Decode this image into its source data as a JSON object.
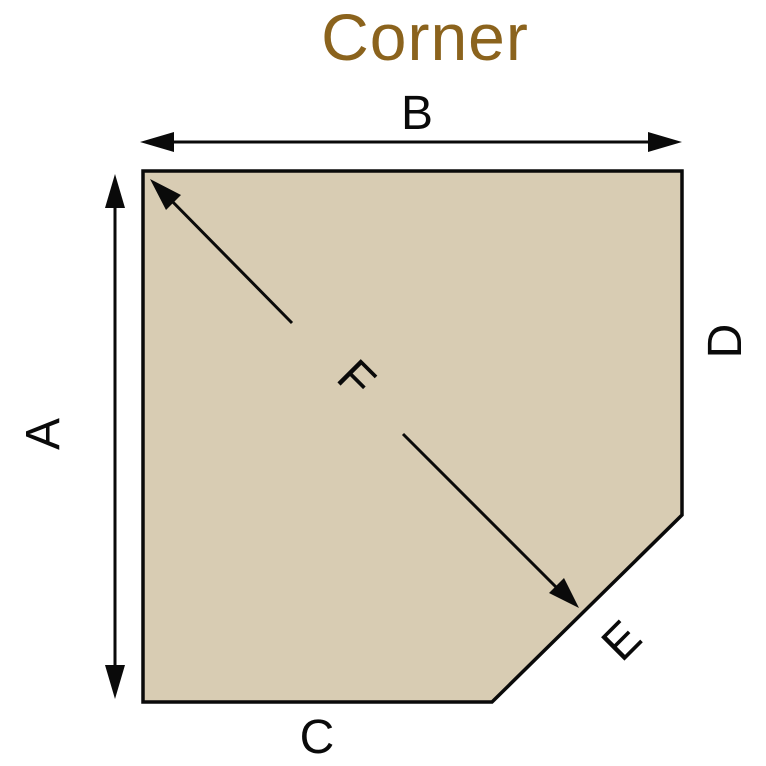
{
  "title": {
    "text": "Corner",
    "color": "#8B631D"
  },
  "canvas": {
    "background": "#FFFFFF",
    "ink": "#0A0A0A"
  },
  "shape": {
    "description": "square pad with clipped bottom-right corner (pentagon)",
    "fill": "#D8CCB3",
    "stroke": "#0A0A0A",
    "points": "143,171 682,171 682,515 492,702 143,702"
  },
  "dimensions": [
    {
      "label": "A",
      "side": "left",
      "arrow": "double-headed"
    },
    {
      "label": "B",
      "side": "top",
      "arrow": "double-headed"
    },
    {
      "label": "C",
      "side": "bottom",
      "arrow": "none"
    },
    {
      "label": "D",
      "side": "right",
      "arrow": "none"
    },
    {
      "label": "E",
      "side": "diagonal-corner-cut",
      "arrow": "none"
    },
    {
      "label": "F",
      "side": "corner-to-cut-depth",
      "arrow": "double-headed"
    }
  ]
}
